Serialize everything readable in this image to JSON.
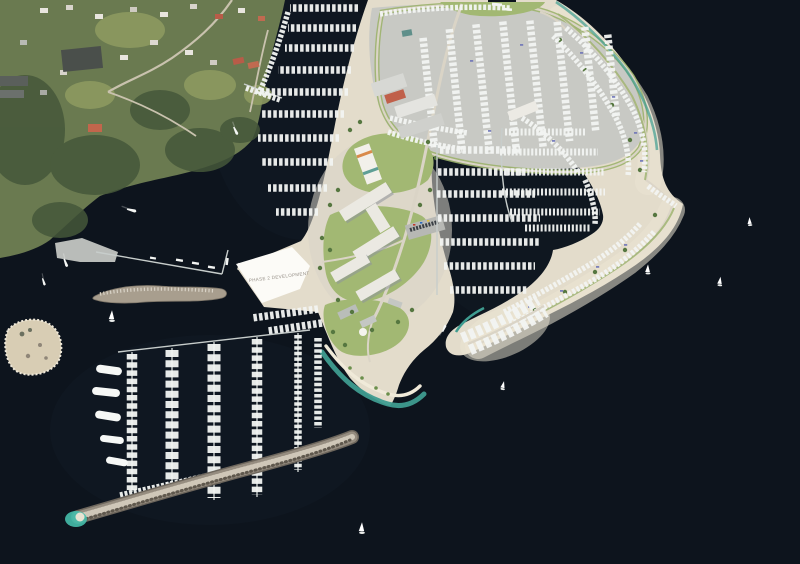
{
  "scene": {
    "description": "Aerial 3D rendering of a coastal marina resort masterplan: hillside town upper-left, central marina village with boatyard, curved sandy breakwater peninsula on the right, superyacht marina and rock breakwater lower-left, dark open water with scattered sailboats",
    "labels": {
      "phase2_parcel": "PHASE 2 DEVELOPMENT"
    },
    "palette": {
      "water": "#0d141d",
      "water_sheen": "#1c2936",
      "hillside": "#6a7a50",
      "forest": "#45573a",
      "field": "#8d9a60",
      "sand": "#e3dccb",
      "sand_bright": "#ece5d4",
      "pavement": "#c8c9c4",
      "road": "#dad4c6",
      "lawn": "#a2b873",
      "dock": "#c7cdcb",
      "boat_white": "#f3f5f3",
      "boat_wrap": "#6f76b8",
      "rock": "#968d80",
      "rock_light": "#cfc7b8",
      "lagoon_teal": "#45bcab",
      "shore_teal": "#3f9c90",
      "roof_red": "#b85c48",
      "shed_dark": "#4a4f4b",
      "parcel_white": "#fcfbf7",
      "label_text": "#98928a"
    },
    "open_water_sailboats": [
      {
        "x": 112,
        "y": 318,
        "r": 0,
        "s": 1.1
      },
      {
        "x": 362,
        "y": 530,
        "r": 0,
        "s": 1.1
      },
      {
        "x": 503,
        "y": 387,
        "r": 10,
        "s": 0.85
      },
      {
        "x": 648,
        "y": 271,
        "r": 0,
        "s": 0.95
      },
      {
        "x": 720,
        "y": 283,
        "r": 5,
        "s": 0.9
      },
      {
        "x": 750,
        "y": 223,
        "r": -5,
        "s": 0.85
      }
    ],
    "powerboats": [
      {
        "x": 132,
        "y": 210,
        "r": 20,
        "s": 1
      },
      {
        "x": 236,
        "y": 131,
        "r": 70,
        "s": 0.9
      },
      {
        "x": 66,
        "y": 263,
        "r": 75,
        "s": 0.9
      },
      {
        "x": 44,
        "y": 282,
        "r": 78,
        "s": 0.8
      },
      {
        "x": 444,
        "y": 328,
        "r": -60,
        "s": 0.8
      }
    ]
  }
}
